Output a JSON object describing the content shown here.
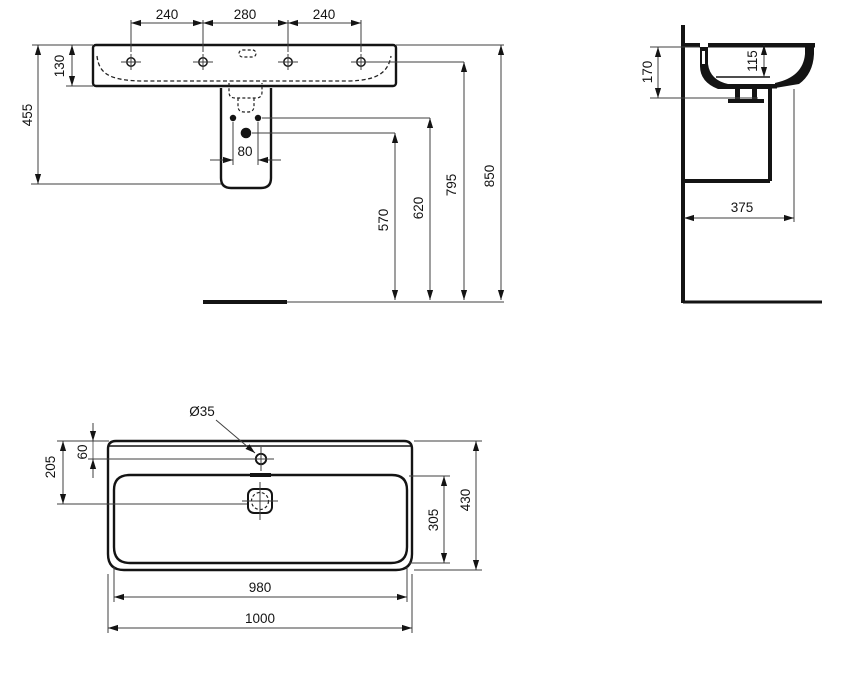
{
  "drawing_title": "Wall-hung washbasin dimensional drawing",
  "front_view": {
    "dim_tap_spacing_left": "240",
    "dim_tap_spacing_center": "280",
    "dim_tap_spacing_right": "240",
    "dim_basin_apron_height": "130",
    "dim_rim_to_trap_bottom": "455",
    "dim_supply_spacing": "80",
    "dim_drain_outlet_height": "570",
    "dim_supply_height": "620",
    "dim_tap_holes_height": "795",
    "dim_rim_height": "850"
  },
  "side_view": {
    "dim_section_height": "170",
    "dim_bowl_depth": "115",
    "dim_depth_from_wall": "375"
  },
  "plan_view": {
    "dim_tap_hole_diameter": "Ø35",
    "dim_tap_hole_from_back": "60",
    "dim_drain_from_back": "205",
    "dim_bowl_inner_depth": "305",
    "dim_overall_depth": "430",
    "dim_bowl_inner_width": "980",
    "dim_overall_width": "1000"
  }
}
